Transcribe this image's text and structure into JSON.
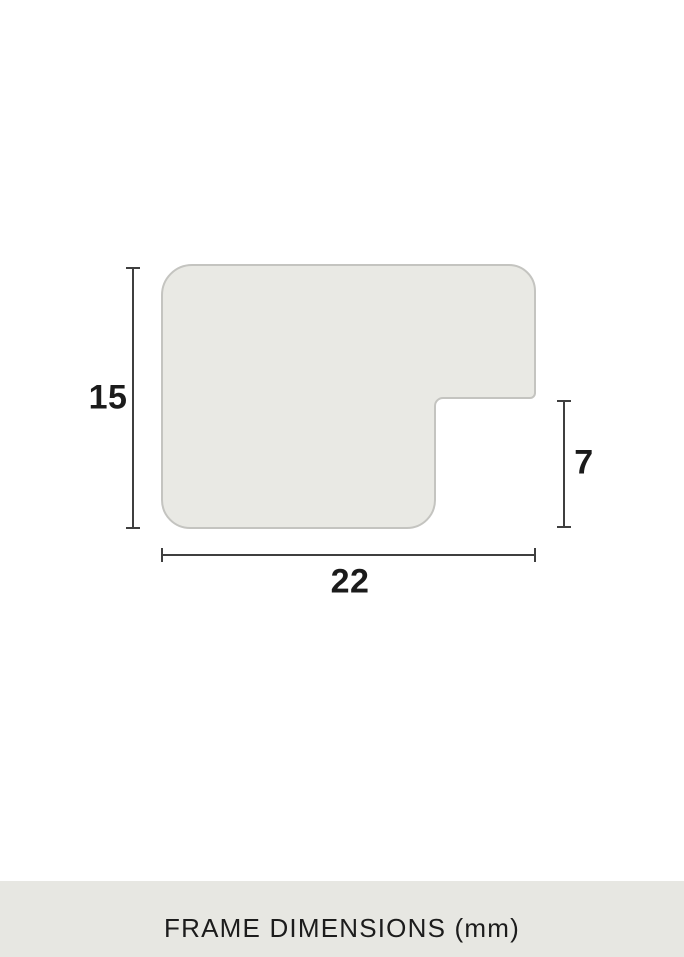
{
  "diagram": {
    "dimension_labels": {
      "height": "15",
      "notch_height": "7",
      "width": "22"
    }
  },
  "footer": {
    "caption": "FRAME DIMENSIONS (mm)"
  },
  "colors": {
    "background": "#ffffff",
    "shape_fill": "#e9e9e4",
    "shape_stroke": "#c4c4c0",
    "dimension_line": "#3f3f3f",
    "label_text": "#1b1b1b",
    "footer_bar": "#e7e7e2",
    "footer_text": "#1c1c1c"
  }
}
